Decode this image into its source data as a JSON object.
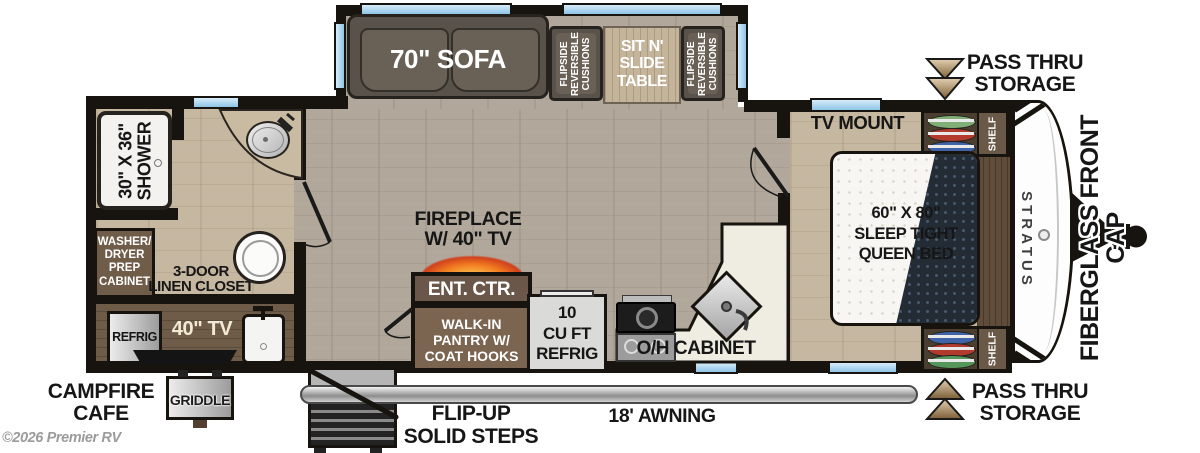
{
  "watermark": "©2026 Premier RV",
  "colors": {
    "wall": "#17130e",
    "floor_main": "#b1a89b",
    "floor_warm": "#c6b7a0",
    "compartment_brown": "#6f5c48",
    "cabinet_brown": "#7b6551",
    "window_blue": "#aed7f0",
    "counter_cream": "#efece1",
    "fire_orange": "#f07820",
    "awning_gray": "#c0c0c0",
    "hanger_green": "#7fae77",
    "hanger_red": "#b23b2e",
    "hanger_blue": "#3f63a6"
  },
  "slide": {
    "sofa_label": "70\" SOFA",
    "cushion_lines": [
      "FLIPSIDE",
      "REVERSIBLE",
      "CUSHIONS"
    ],
    "table_lines": [
      "SIT N'",
      "SLIDE",
      "TABLE"
    ]
  },
  "storage": {
    "top_lines": [
      "PASS THRU",
      "STORAGE"
    ],
    "bottom_lines": [
      "PASS THRU",
      "STORAGE"
    ]
  },
  "bedroom": {
    "tv_mount": "TV MOUNT",
    "shelf": "SHELF",
    "bed_lines": [
      "60\" X 80\"",
      "SLEEP TIGHT",
      "QUEEN BED"
    ],
    "brand": "STRATUS",
    "front_cap": "FIBERGLASS FRONT CAP"
  },
  "bathroom": {
    "shower_lines": [
      "30\" X 36\"",
      "SHOWER"
    ],
    "washer_lines": [
      "WASHER/",
      "DRYER",
      "PREP",
      "CABINET"
    ],
    "linen_lines": [
      "3-DOOR",
      "LINEN CLOSET"
    ]
  },
  "living": {
    "fireplace_lines": [
      "FIREPLACE",
      "W/ 40\" TV"
    ],
    "ent_ctr": "ENT. CTR.",
    "pantry_lines": [
      "WALK-IN",
      "PANTRY W/",
      "COAT HOOKS"
    ]
  },
  "kitchen": {
    "refrig_lines": [
      "10",
      "CU FT",
      "REFRIG"
    ],
    "oh_cabinet": "O/H CABINET"
  },
  "exterior": {
    "campfire_lines": [
      "CAMPFIRE",
      "CAFE"
    ],
    "griddle": "GRIDDLE",
    "refrig": "REFRIG",
    "tv": "40\" TV",
    "steps_lines": [
      "FLIP-UP",
      "SOLID STEPS"
    ],
    "awning": "18' AWNING"
  }
}
